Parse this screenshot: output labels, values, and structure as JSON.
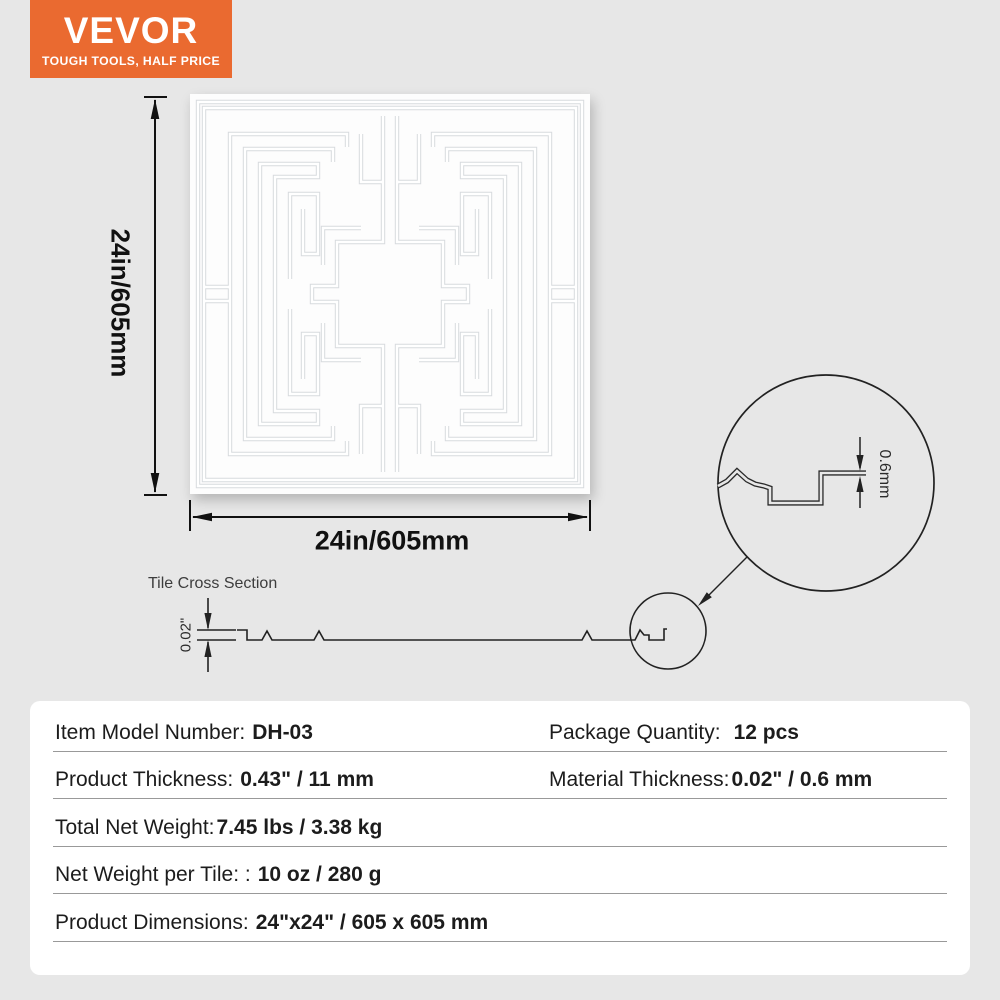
{
  "colors": {
    "accent_orange": "#ea6a30",
    "page_bg": "#e7e7e7"
  },
  "brand": {
    "name": "VEVOR",
    "tagline": "TOUGH TOOLS, HALF PRICE"
  },
  "diagram": {
    "height_label": "24in/605mm",
    "width_label": "24in/605mm",
    "cross_section_title": "Tile Cross Section",
    "cross_section_thickness": "0.02\"",
    "magnified_thickness": "0.6mm"
  },
  "specs": {
    "rows": [
      {
        "label": "Item Model Number:",
        "value": "DH-03",
        "label2": "Package Quantity:",
        "value2": "12 pcs"
      },
      {
        "label": "Product Thickness:",
        "value": "0.43\" / 11 mm",
        "label2": "Material Thickness:",
        "value2": "0.02\" / 0.6 mm"
      },
      {
        "label": "Total Net Weight:",
        "value": "7.45 lbs / 3.38 kg"
      },
      {
        "label": "Net Weight per Tile: :",
        "value": "10 oz / 280 g"
      },
      {
        "label": "Product Dimensions:",
        "value": "24\"x24\" / 605 x 605 mm"
      }
    ]
  }
}
